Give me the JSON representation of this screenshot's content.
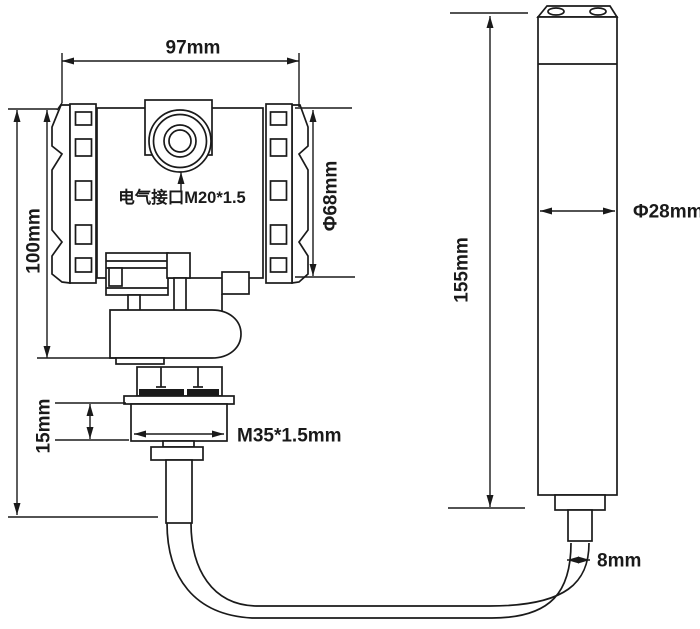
{
  "drawing": {
    "transmitter": {
      "width_label": "97mm",
      "height_label": "100mm",
      "cap_diameter_label": "Φ68mm",
      "electrical_port_label": "电气接口M20*1.5",
      "nut_height_label": "15mm",
      "thread_label": "M35*1.5mm"
    },
    "probe": {
      "length_label": "155mm",
      "diameter_label": "Φ28mm",
      "cable_diameter_label": "8mm"
    },
    "colors": {
      "line": "#1a1a1a",
      "background": "#ffffff"
    }
  }
}
